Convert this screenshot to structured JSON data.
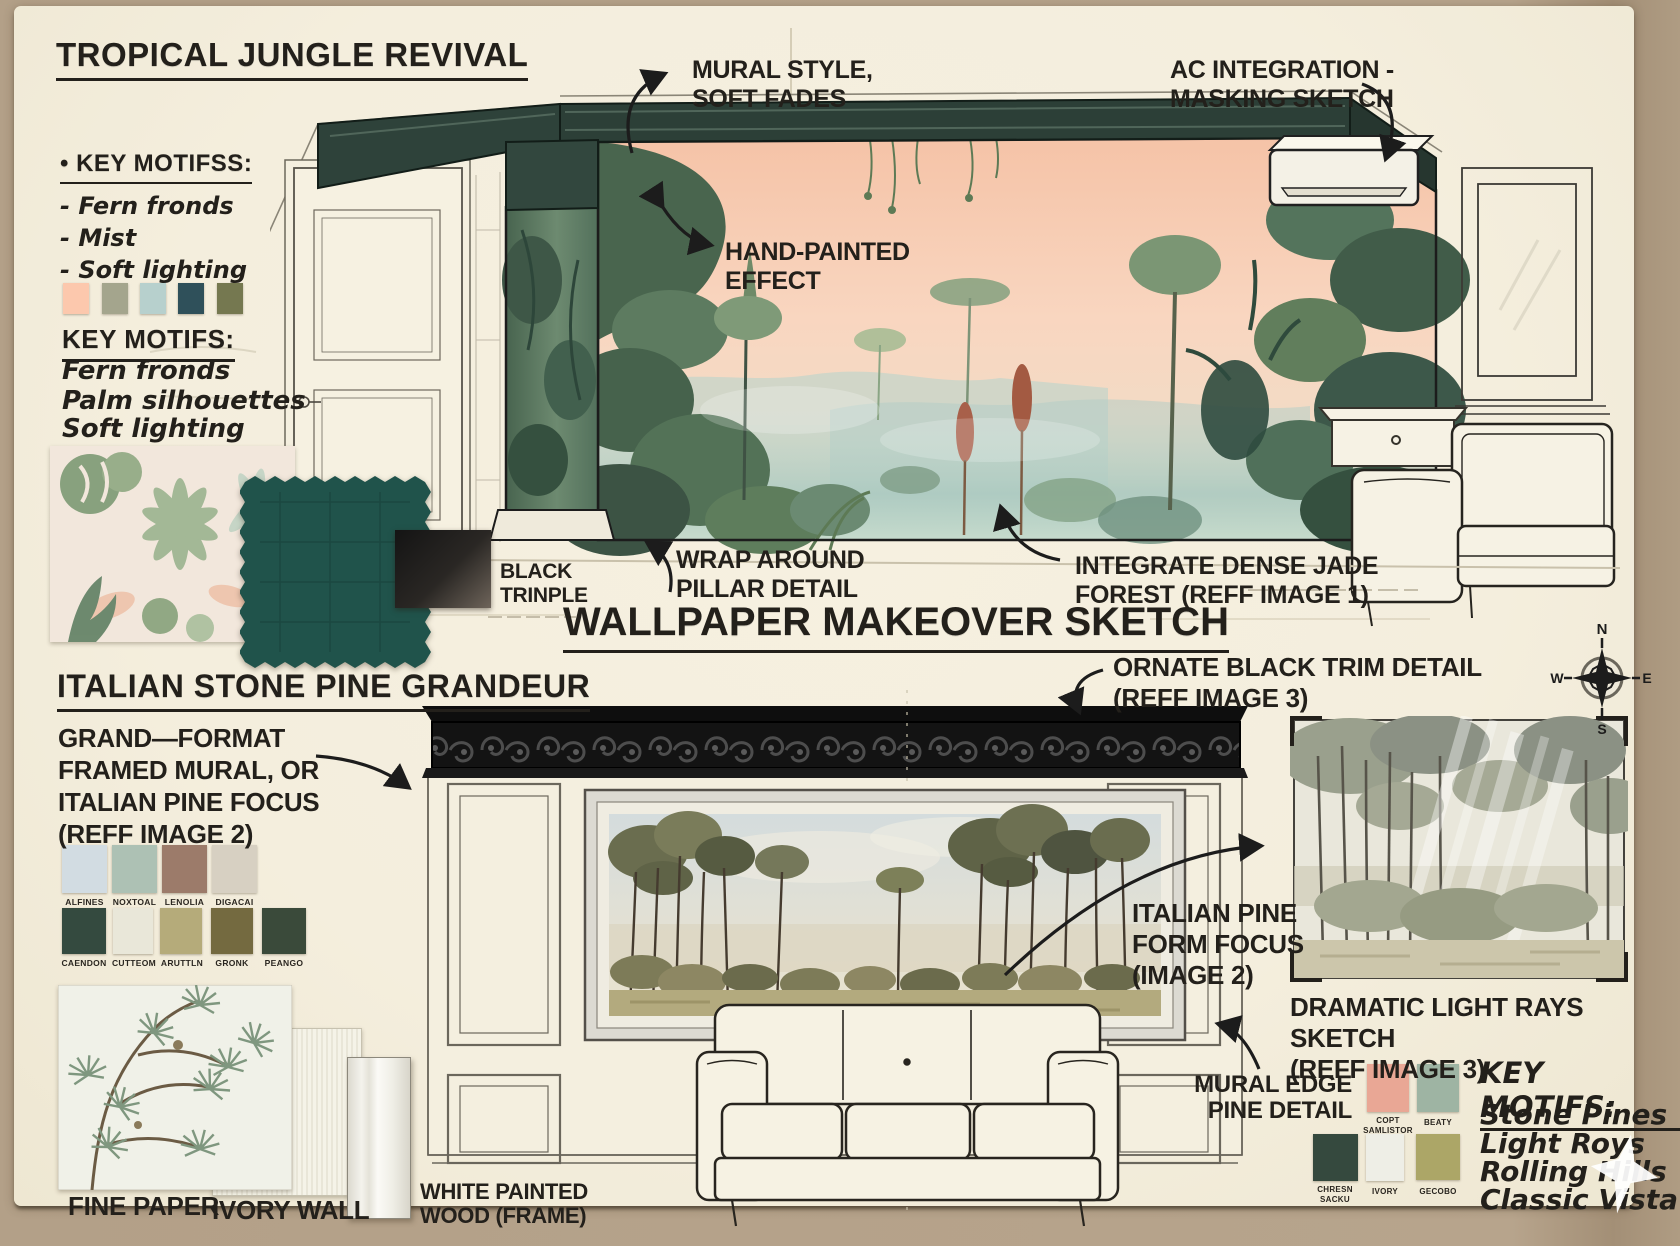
{
  "colors": {
    "board": "#f4eedd",
    "kraft": "#b3a088",
    "ink": "#23201b",
    "trim_green": "#2e423a",
    "mural_sky_peach": "#f5c3a7",
    "teal_fabric": "#20534b",
    "cornice_black": "#131313"
  },
  "top": {
    "title": "TROPICAL JUNGLE REVIVAL",
    "bullet_heading": "• KEY MOTIFSS:",
    "bullet_items": [
      "- Fern fronds",
      "- Mist",
      "- Soft lighting"
    ],
    "palette": [
      "#fcc8ad",
      "#a4a58d",
      "#b7d0cd",
      "#2f505a",
      "#757850"
    ],
    "motifs_heading": "KEY MOTIFS:",
    "motifs_items": [
      "Fern fronds",
      "Palm silhouettes",
      "Soft lighting"
    ],
    "black_swatch_label": "BLACK\nTRINPLE",
    "annotations": {
      "mural_style": "MURAL STYLE,\nSOFT FADES",
      "ac_integration": "AC INTEGRATION -\nMASKING SKETCH",
      "hand_painted": "HAND-PAINTED\nEFFECT",
      "wrap_around": "WRAP AROUND\nPILLAR DETAIL",
      "jade_forest": "INTEGRATE DENSE JADE\nFOREST (REFF IMAGE 1)"
    }
  },
  "center_title": "WALLPAPER MAKEOVER SKETCH",
  "bottom": {
    "title": "ITALIAN STONE PINE GRANDEUR",
    "format_note": "GRAND—FORMAT\nFRAMED MURAL, OR\nITALIAN PINE FOCUS\n(REFF IMAGE 2)",
    "palette_row1": [
      {
        "label": "ALFINES",
        "color": "#d2dce2"
      },
      {
        "label": "NOXTOAL",
        "color": "#adc1b4"
      },
      {
        "label": "LENOLIA",
        "color": "#9c7b6a"
      },
      {
        "label": "DIGACAI",
        "color": "#d7d0c2"
      }
    ],
    "palette_row2": [
      {
        "label": "CAENDON",
        "color": "#344a3f"
      },
      {
        "label": "CUTTEOM",
        "color": "#e9e7d9"
      },
      {
        "label": "ARUTTLN",
        "color": "#b5ab7a"
      },
      {
        "label": "GRONK",
        "color": "#746a40"
      },
      {
        "label": "PEANGO",
        "color": "#3a4a3a"
      }
    ],
    "materials": {
      "fine_paper": "FINE PAPER",
      "ivory_wall": "IVORY WALL",
      "white_wood": "WHITE PAINTED\nWOOD (FRAME)"
    },
    "annotations": {
      "ornate_trim": "ORNATE BLACK TRIM DETAIL\n(REFF IMAGE 3)",
      "pine_focus": "ITALIAN PINE\nFORM FOCUS\n(IMAGE 2)",
      "light_rays": "DRAMATIC LIGHT RAYS SKETCH\n(REFF IMAGE 3)",
      "mural_edge": "MURAL EDGE\nPINE DETAIL"
    },
    "right_swatches": [
      {
        "label": "COPT\nSAMLISTOR",
        "color": "#e9a795"
      },
      {
        "label": "BEATY",
        "color": "#9eb4a3"
      },
      {
        "label": "CHRESN\nSACKU",
        "color": "#35493e"
      },
      {
        "label": "IVORY",
        "color": "#eeeee6"
      },
      {
        "label": "GECOBO",
        "color": "#aca667"
      }
    ],
    "motifs_heading": "KEY MOTIFS:",
    "motifs_items": [
      "Stone Pines",
      "Light Roys",
      "Rolling Hills",
      "Classic Vista"
    ]
  },
  "compass": {
    "n": "N",
    "e": "E",
    "s": "S",
    "w": "W"
  }
}
